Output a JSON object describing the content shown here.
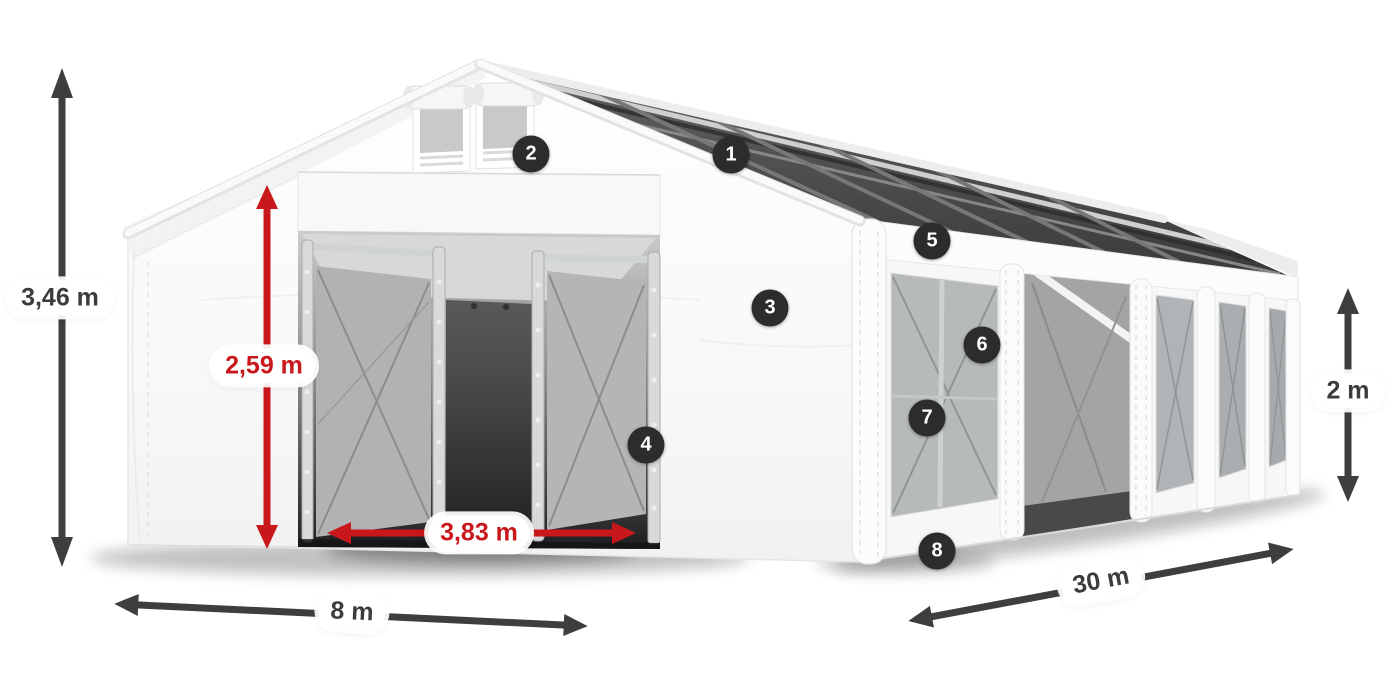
{
  "diagram": {
    "callouts": [
      "1",
      "2",
      "3",
      "4",
      "5",
      "6",
      "7",
      "8"
    ],
    "dimensions": {
      "total_height": "3,46 m",
      "inner_height": "2,59 m",
      "door_width": "3,83 m",
      "width": "8 m",
      "length": "30 m",
      "side_height": "2 m"
    },
    "colors": {
      "accent_red": "#c8181b",
      "arrow_dark": "#3e3e40",
      "badge_background": "#2c2c2e",
      "label_background": "#ffffff",
      "tent_white": "#fafafa",
      "roof_clear_panel_dark": "#3a3a3c"
    },
    "icons": {
      "dimension_arrow": "double-headed-arrow",
      "callout_marker": "numbered-circle"
    }
  }
}
